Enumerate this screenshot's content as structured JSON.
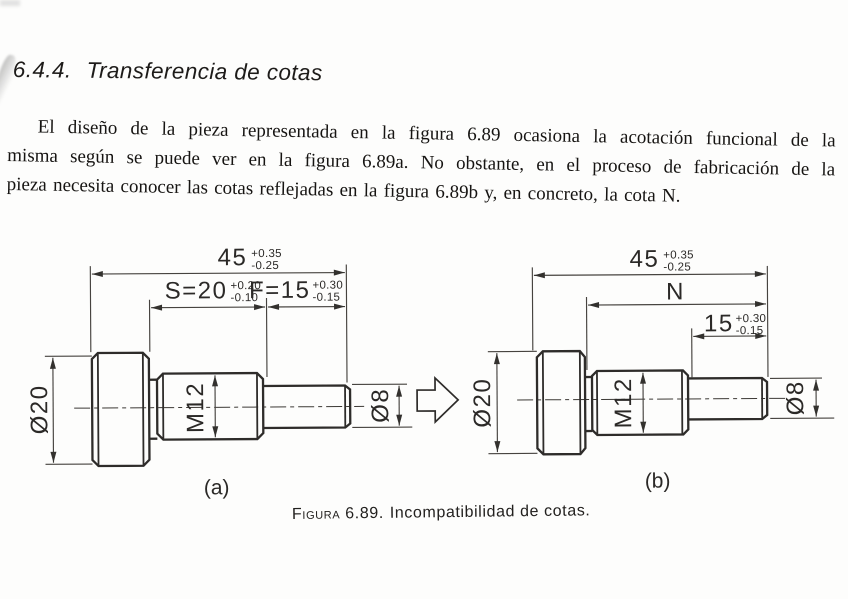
{
  "document": {
    "section_number": "6.4.4.",
    "section_title": "Transferencia de cotas",
    "paragraph_lines": [
      "El diseño de la pieza representada en la figura 6.89 ocasiona la acotación funcional de la",
      "misma según se puede ver en la figura 6.89a. No obstante, en el proceso de fabricación de la",
      "pieza necesita conocer las cotas reflejadas en la figura 6.89b y, en concreto, la cota N."
    ],
    "caption_label": "Figura 6.89.",
    "caption_text": "Incompatibilidad de cotas."
  },
  "figure": {
    "drawing_a": {
      "label": "(a)",
      "dim_overall": {
        "value": "45",
        "tol_plus": "+0.35",
        "tol_minus": "-0.25"
      },
      "dim_s": {
        "value": "S=20",
        "tol_plus": "+0.20",
        "tol_minus": "-0.10"
      },
      "dim_f": {
        "value": "F=15",
        "tol_plus": "+0.30",
        "tol_minus": "-0.15"
      },
      "dim_head_diameter": "Ø20",
      "dim_thread": "M12",
      "dim_shaft_diameter": "Ø8"
    },
    "drawing_b": {
      "label": "(b)",
      "dim_overall": {
        "value": "45",
        "tol_plus": "+0.35",
        "tol_minus": "-0.25"
      },
      "dim_n": "N",
      "dim_length": {
        "value": "15",
        "tol_plus": "+0.30",
        "tol_minus": "-0.15"
      },
      "dim_head_diameter": "Ø20",
      "dim_thread": "M12",
      "dim_shaft_diameter": "Ø8"
    }
  },
  "colors": {
    "paper": "#fdfdfc",
    "ink": "#1d1b19",
    "drawing_line": "#2e2c2a"
  }
}
